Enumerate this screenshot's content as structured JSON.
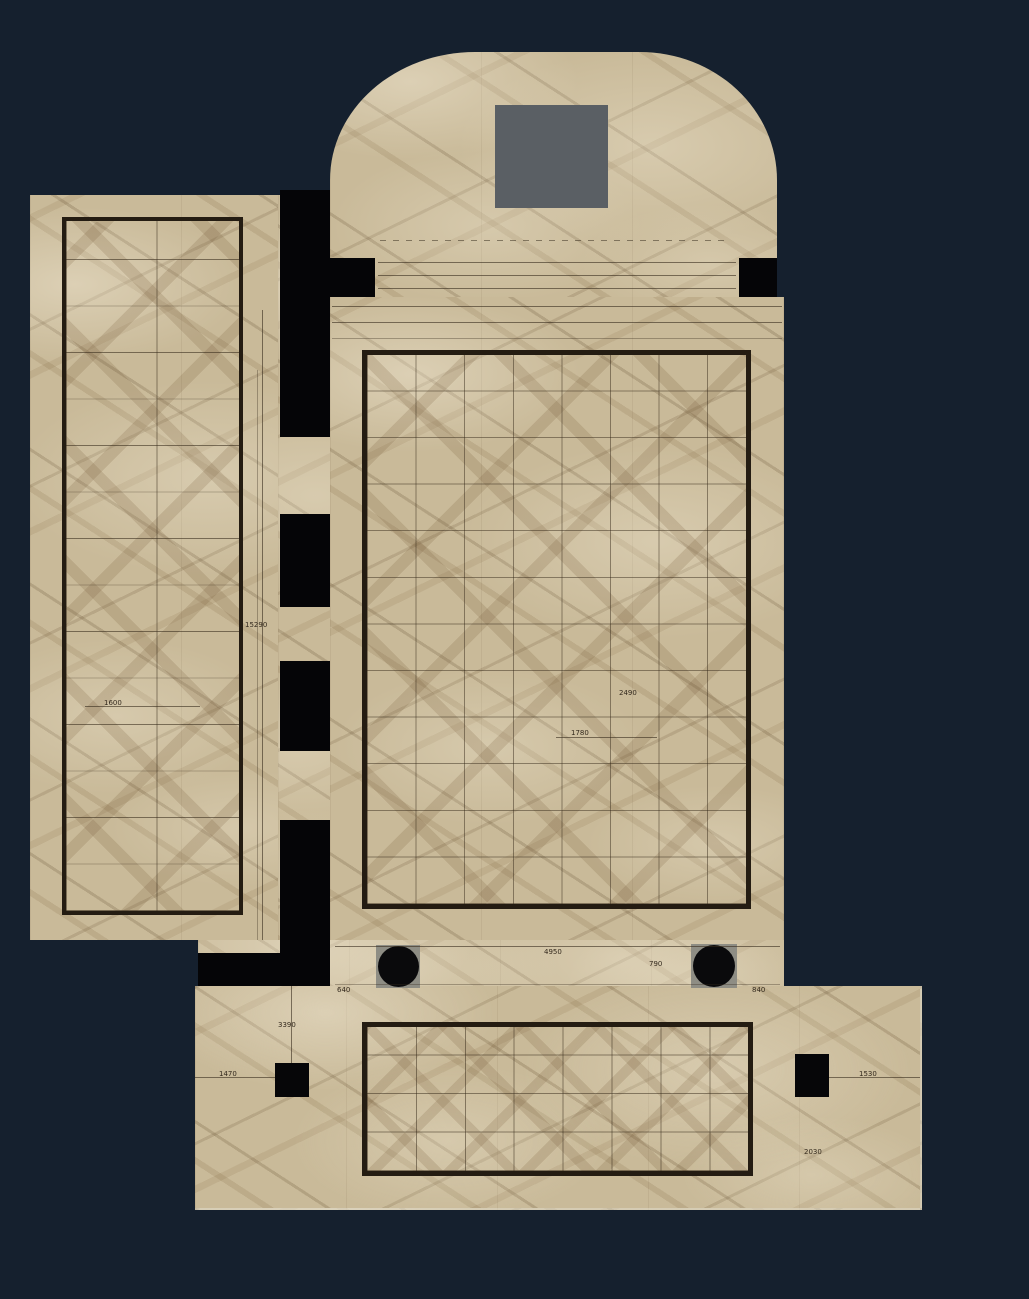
{
  "scene": {
    "description": "Rendered architectural floor plan of marble tiling (book-matched beige marble) on a dark navy background: arched top hall with gray niche square, large central tiled hall, tall left side hall, lower tiled hall, black wall segments with door openings, two round columns on gray bases and two square columns.",
    "round_columns": 2,
    "square_columns": 2
  },
  "colors": {
    "background": "#15202e",
    "marble_base": "#c9ba99",
    "wall_black": "#050507",
    "tile_border": "#241c12",
    "niche_gray": "#5a5f64",
    "column_base_gray": "#8e8d84",
    "dimension_text": "#33291d"
  },
  "dims": [
    {
      "text": "15290"
    },
    {
      "text": "1600"
    },
    {
      "text": "2490"
    },
    {
      "text": "1780"
    },
    {
      "text": "4950"
    },
    {
      "text": "790"
    },
    {
      "text": "640"
    },
    {
      "text": "840"
    },
    {
      "text": "3390"
    },
    {
      "text": "1470"
    },
    {
      "text": "1530"
    },
    {
      "text": "2030"
    }
  ]
}
